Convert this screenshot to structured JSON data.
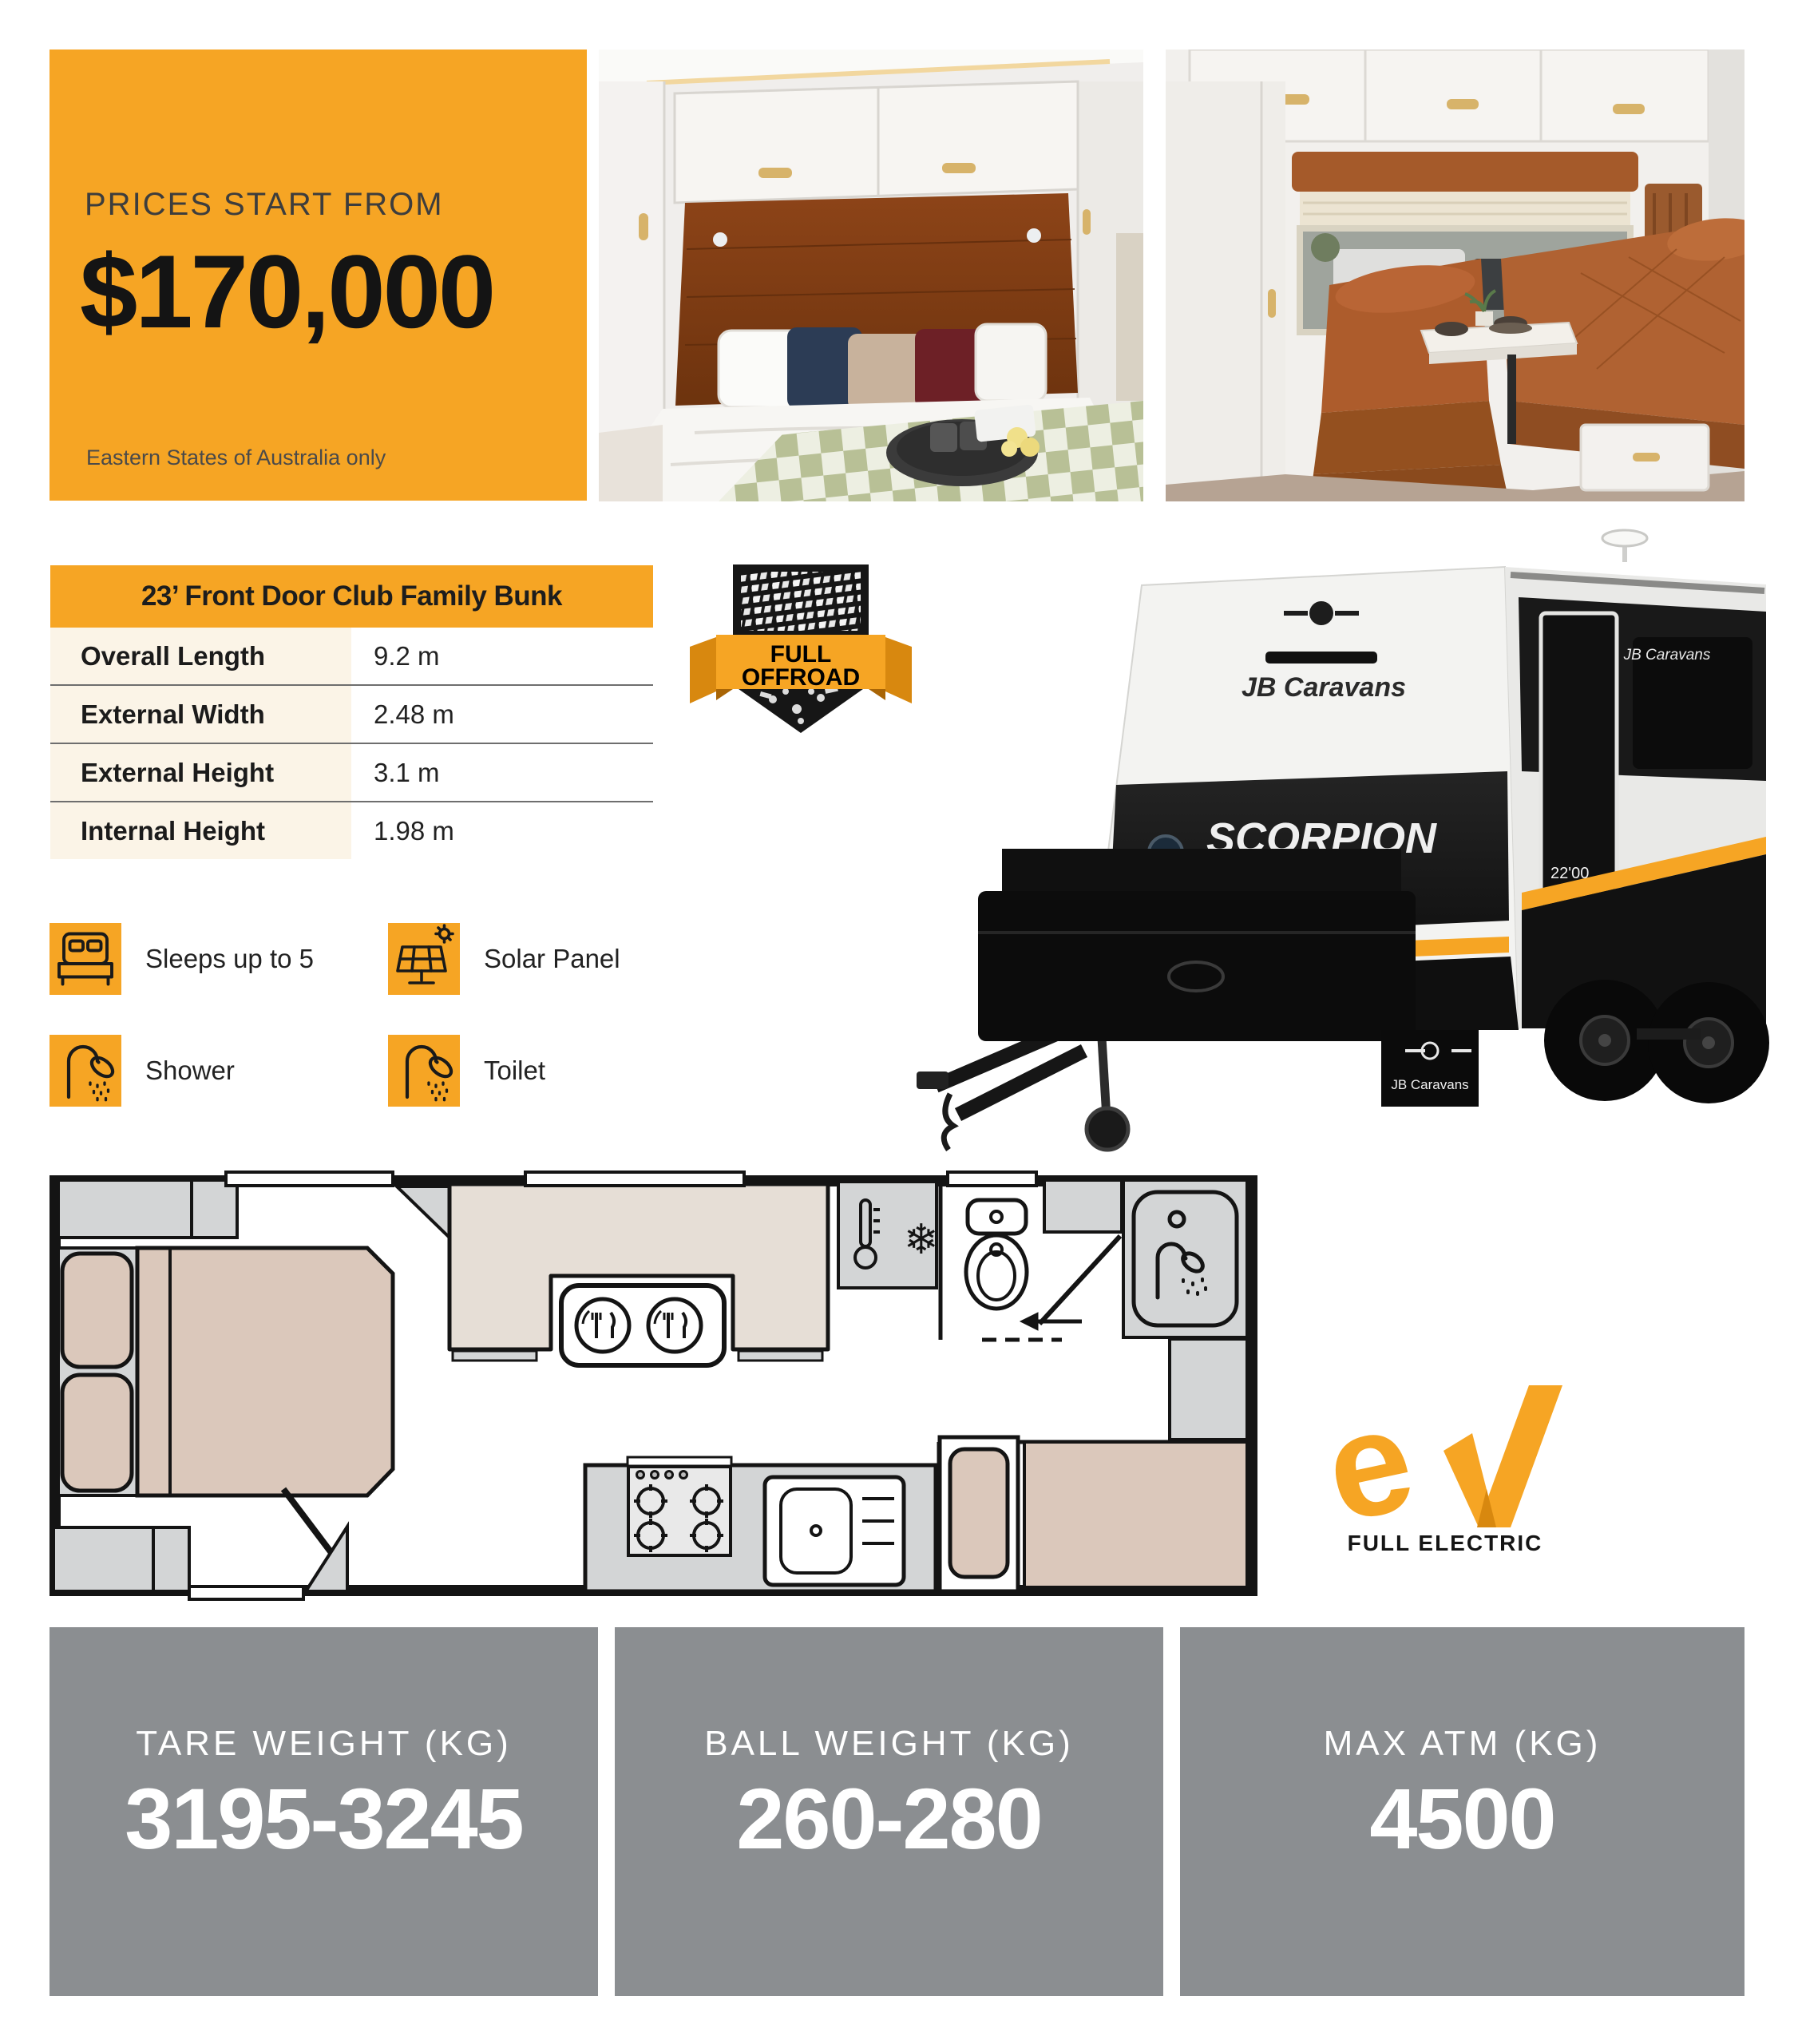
{
  "colors": {
    "orange": "#F6A524",
    "orange_dark": "#D8880F",
    "cream": "#FBF4E7",
    "gray_box": "#8B8E91",
    "plan_gray": "#D3D5D6",
    "plan_beige": "#DBC8BB",
    "lounge_beige": "#E6DED6",
    "ink": "#111111"
  },
  "price_box": {
    "eyebrow": "PRICES START FROM",
    "price": "$170,000",
    "note": "Eastern States of Australia only"
  },
  "spec_table": {
    "title": "23’ Front Door Club Family Bunk",
    "rows": [
      {
        "label": "Overall Length",
        "value": "9.2 m"
      },
      {
        "label": "External Width",
        "value": "2.48 m"
      },
      {
        "label": "External Height",
        "value": "3.1 m"
      },
      {
        "label": "Internal Height",
        "value": "1.98 m"
      }
    ]
  },
  "features": {
    "items": [
      {
        "icon": "bed-icon",
        "label": "Sleeps up to 5"
      },
      {
        "icon": "solar-panel-icon",
        "label": "Solar Panel"
      },
      {
        "icon": "shower-icon",
        "label": "Shower"
      },
      {
        "icon": "shower-icon",
        "label": "Toilet"
      }
    ]
  },
  "offroad_badge": {
    "line1": "FULL",
    "line2": "OFFROAD"
  },
  "caravan": {
    "brand": "JB Caravans",
    "model": "SCORPION",
    "submodel_1": "STING",
    "submodel_2": "AIR",
    "size_label": "22'00",
    "mudflap_label": "JB Caravans"
  },
  "ev": {
    "logo_text": "eV",
    "logo_e": "e",
    "label": "FULL ELECTRIC"
  },
  "weights": {
    "items": [
      {
        "label": "TARE WEIGHT (KG)",
        "value": "3195-3245"
      },
      {
        "label": "BALL WEIGHT (KG)",
        "value": "260-280"
      },
      {
        "label": "MAX ATM (KG)",
        "value": "4500"
      }
    ]
  }
}
